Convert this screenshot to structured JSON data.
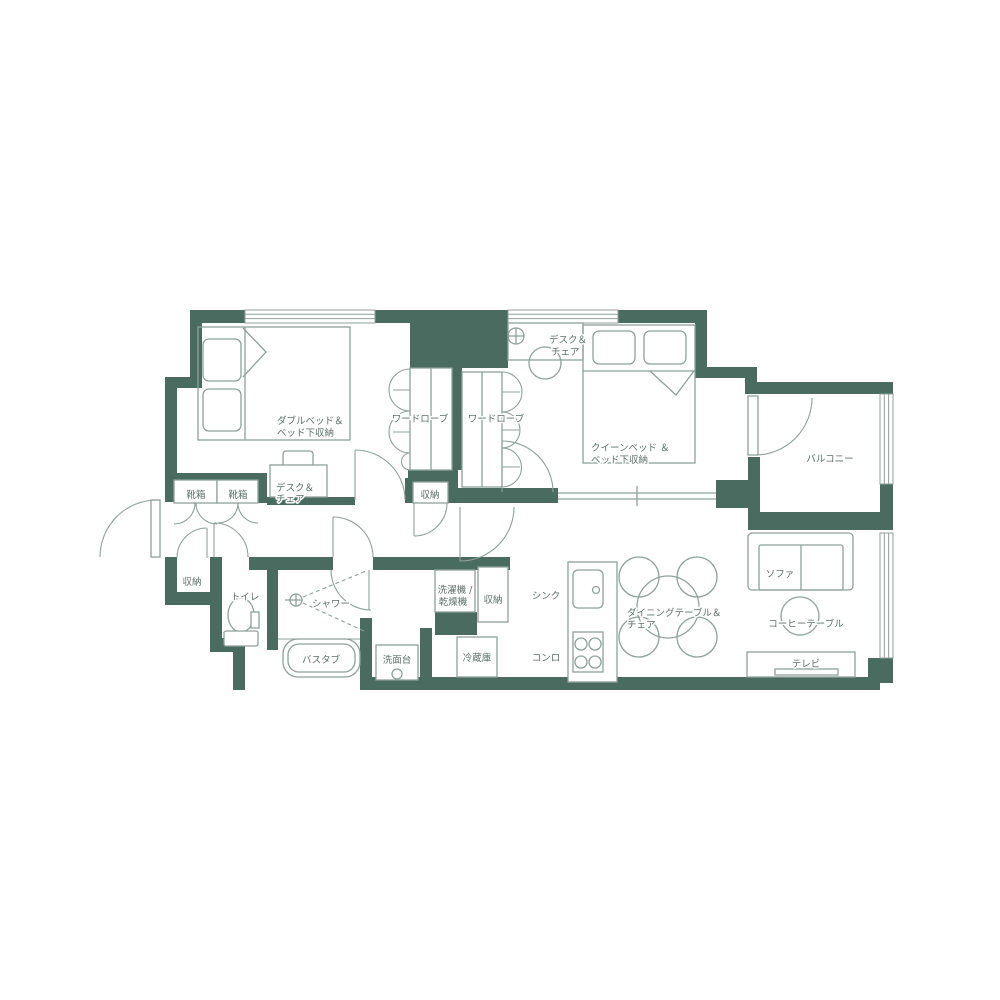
{
  "colors": {
    "wall": "#4a6c60",
    "line": "#8fa09a",
    "label": "#5d6f68"
  },
  "labels": {
    "double_bed": [
      "ダブルベッド＆",
      "ベッド下収納"
    ],
    "desk_chair_bedroom1": [
      "デスク＆",
      "チェア"
    ],
    "shoe_box_left": "靴箱",
    "shoe_box_right": "靴箱",
    "wardrobe_left": "ワードローブ",
    "wardrobe_right": "ワードローブ",
    "storage_hall": "収納",
    "desk_chair_bedroom2": [
      "デスク＆",
      "チェア"
    ],
    "queen_bed": [
      "クイーンベッド ＆",
      "ベッド下収納"
    ],
    "balcony": "バルコニー",
    "storage_entry": "収納",
    "toilet": "トイレ",
    "shower": "シャワー",
    "bathtub": "バスタブ",
    "washbasin": "洗面台",
    "washer_dryer": [
      "洗濯機 /",
      "乾燥機"
    ],
    "storage_laundry": "収納",
    "fridge": "冷蔵庫",
    "sink": "シンク",
    "stove": "コンロ",
    "dining_table": [
      "ダイニングテーブル＆",
      "チェア"
    ],
    "sofa": "ソファ",
    "coffee_table": "コーヒーテーブル",
    "tv": "テレビ"
  }
}
